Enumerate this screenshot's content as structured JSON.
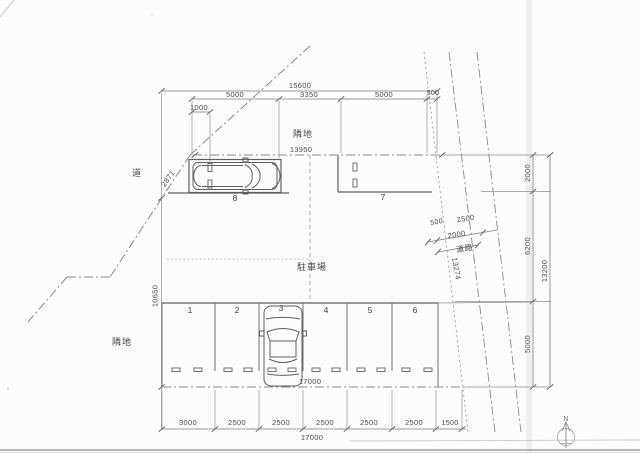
{
  "document": {
    "type": "scanned parking lot site plan"
  },
  "labels": {
    "road_left": "道",
    "road_right": "道路",
    "adjacent_top": "隣地",
    "adjacent_left": "隣地",
    "parking_area": "駐車場",
    "north": "N"
  },
  "dimensions": {
    "top_total": "15600",
    "top_seg_1": "5000",
    "top_seg_2": "3350",
    "top_seg_3": "5000",
    "top_seg_4": "500",
    "wheelstop_offset": "1000",
    "north_boundary": "13950",
    "northwest_diagonal": "2871",
    "west_height": "10650",
    "east_seg_1": "2000",
    "east_seg_2": "6200",
    "east_seg_3": "5000",
    "east_total": "13200",
    "road_seg_1": "500",
    "road_seg_2": "2500",
    "road_width": "2000",
    "road_length": "13274",
    "south_inner_total": "17000",
    "bottom_seg_1": "3000",
    "bottom_seg_2": "2500",
    "bottom_seg_3": "2500",
    "bottom_seg_4": "2500",
    "bottom_seg_5": "2500",
    "bottom_seg_6": "2500",
    "bottom_seg_7": "1500",
    "bottom_total": "17000"
  },
  "spaces": {
    "s1": "1",
    "s2": "2",
    "s3": "3",
    "s4": "4",
    "s5": "5",
    "s6": "6",
    "s7": "7",
    "s8": "8"
  }
}
